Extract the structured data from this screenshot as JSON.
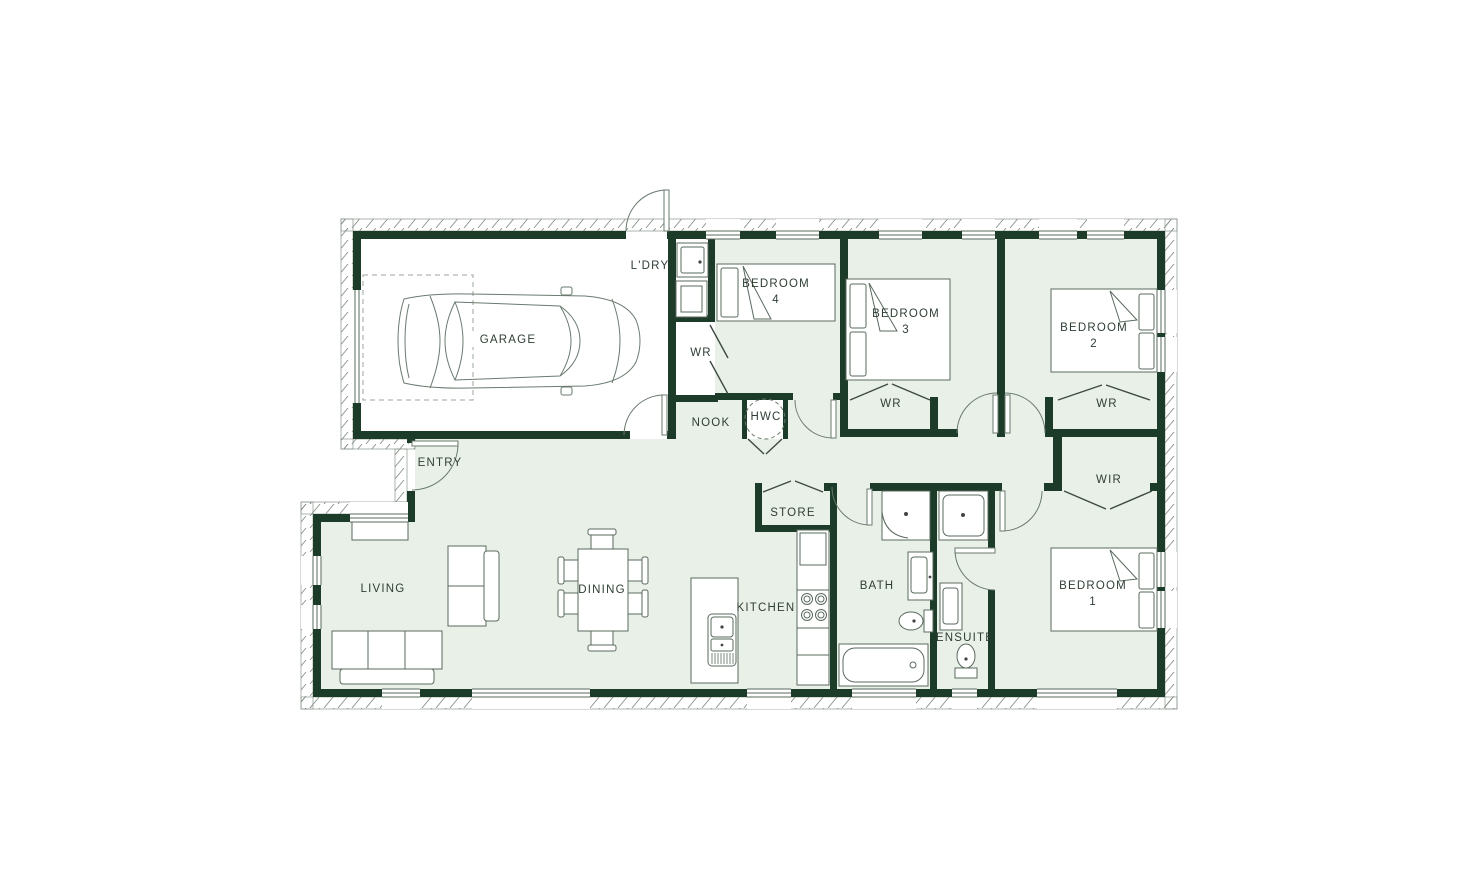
{
  "plan_type": "residential floor plan",
  "labels": {
    "garage": "GARAGE",
    "laundry": "L'DRY",
    "bedroom": "BEDROOM",
    "bedroom1_num": "1",
    "bedroom2_num": "2",
    "bedroom3_num": "3",
    "bedroom4_num": "4",
    "wardrobe": "WR",
    "walk_in_robe": "WIR",
    "nook": "NOOK",
    "hot_water_cylinder": "HWC",
    "entry": "ENTRY",
    "living": "LIVING",
    "dining": "DINING",
    "kitchen": "KITCHEN",
    "store": "STORE",
    "bath": "BATH",
    "ensuite": "ENSUITE"
  },
  "colors": {
    "wall": "#1c3b28",
    "interior_fill": "#e9f0e8",
    "garage_fill": "#ffffff",
    "line": "#5a6a5e",
    "label": "#2f3e33"
  }
}
